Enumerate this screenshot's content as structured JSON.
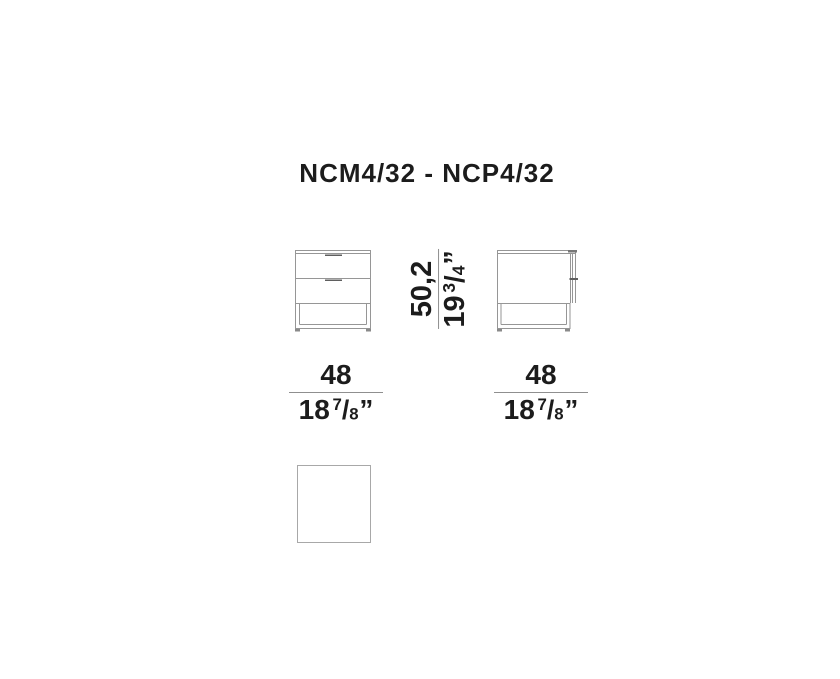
{
  "title": "NCM4/32 - NCP4/32",
  "dimensions": {
    "height": {
      "cm": "50,2",
      "inch_int": "19",
      "frac_num": "3",
      "frac_slash": "/",
      "frac_den": "4",
      "inch_mark": "”"
    },
    "width": {
      "cm": "48",
      "inch_int": "18",
      "frac_num": "7",
      "frac_slash": "/",
      "frac_den": "8",
      "inch_mark": "”"
    },
    "depth": {
      "cm": "48",
      "inch_int": "18",
      "frac_num": "7",
      "frac_slash": "/",
      "frac_den": "8",
      "inch_mark": "”"
    }
  },
  "colors": {
    "line": "#969696",
    "line_dark": "#5f5f5f",
    "text": "#1c1c1c",
    "outline": "#a8a8a8"
  }
}
